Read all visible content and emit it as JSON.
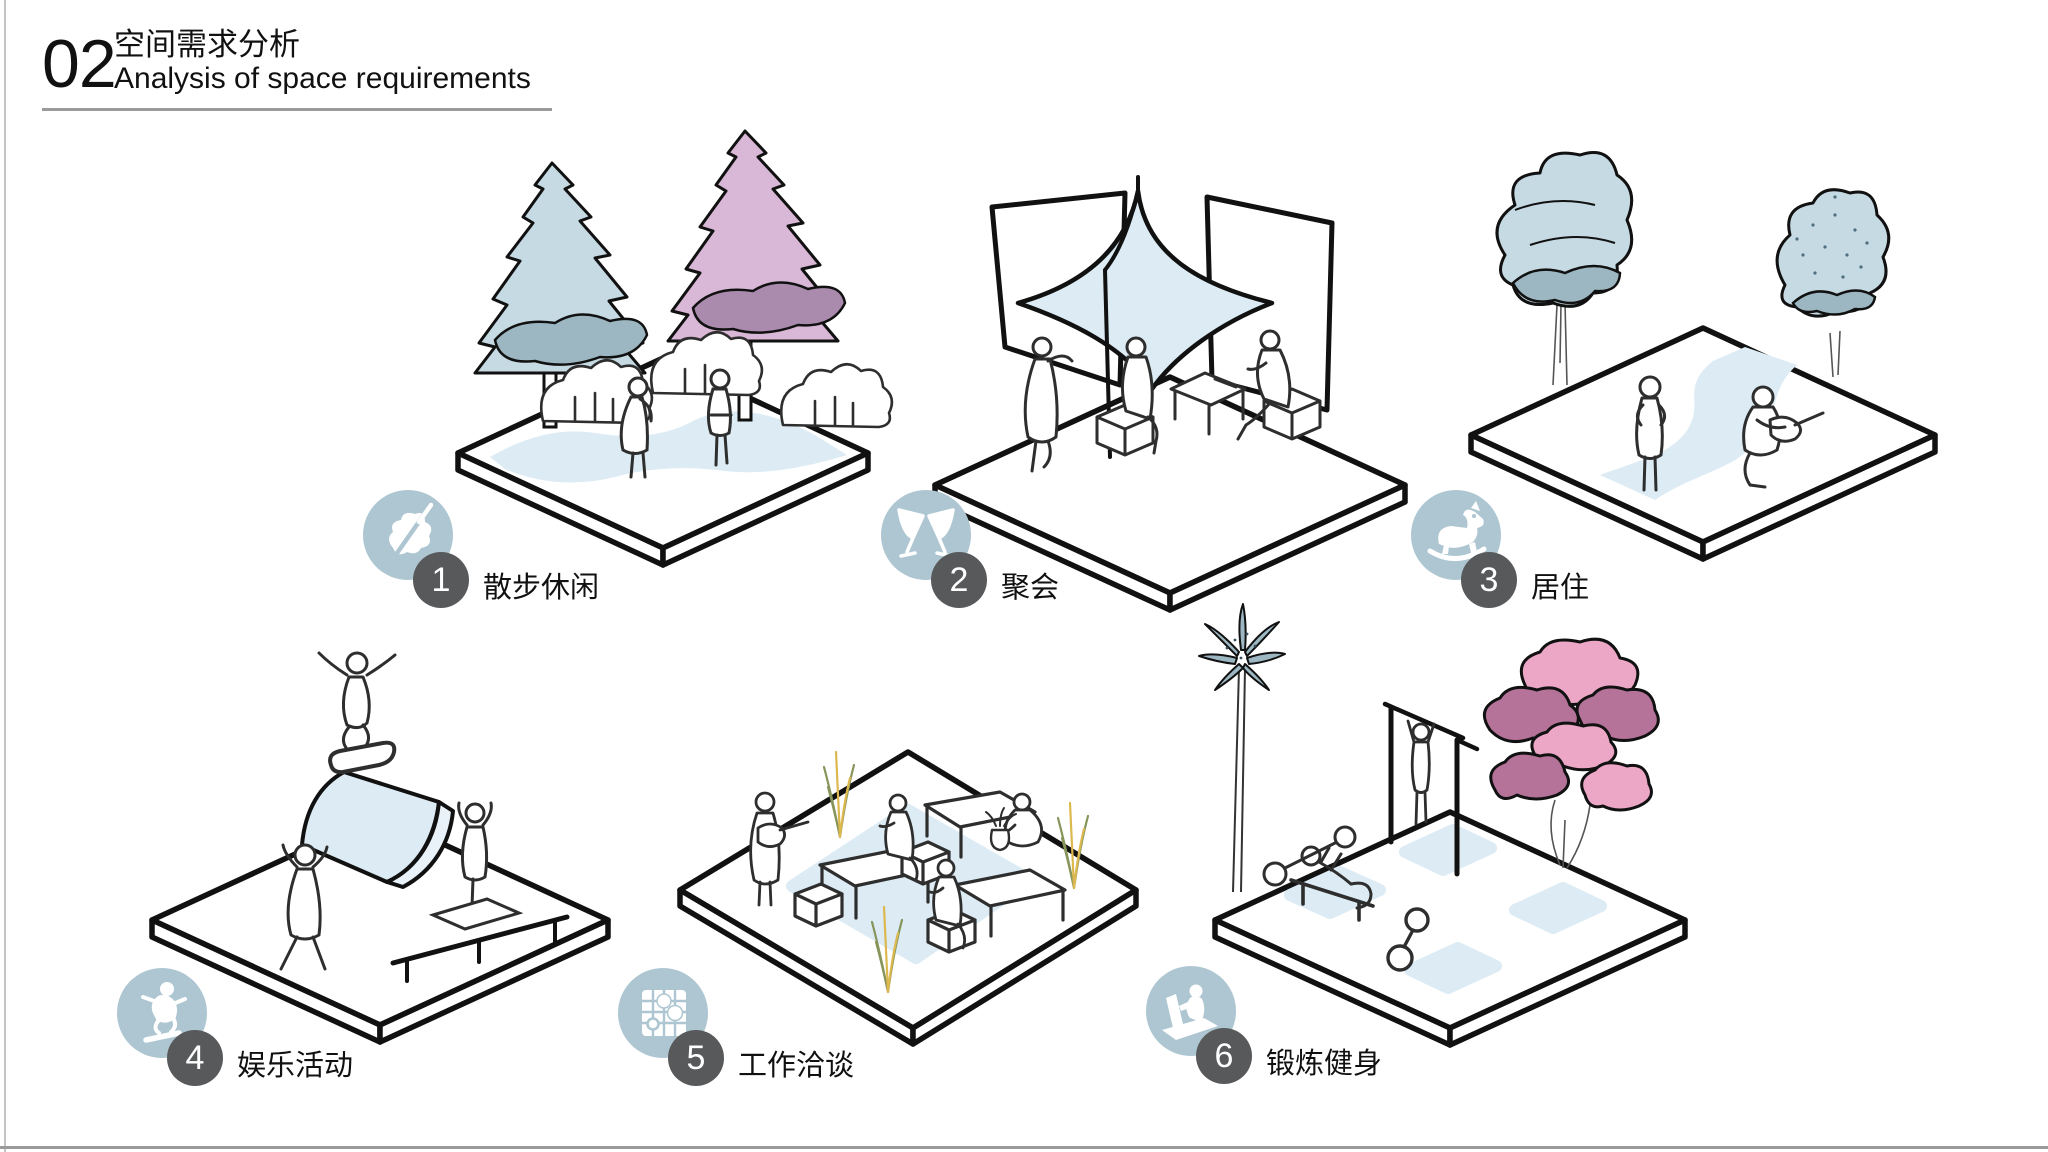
{
  "header": {
    "number": "02",
    "title_zh": "空间需求分析",
    "title_en": "Analysis of space requirements"
  },
  "scenes": [
    {
      "num": "1",
      "label": "散步休闲",
      "icon": "leaf-icon"
    },
    {
      "num": "2",
      "label": "聚会",
      "icon": "toasting-glasses-icon"
    },
    {
      "num": "3",
      "label": "居住",
      "icon": "rocking-horse-icon"
    },
    {
      "num": "4",
      "label": "娱乐活动",
      "icon": "skateboarder-icon"
    },
    {
      "num": "5",
      "label": "工作洽谈",
      "icon": "game-board-icon"
    },
    {
      "num": "6",
      "label": "锻炼健身",
      "icon": "exercise-machine-icon"
    }
  ],
  "colors": {
    "icon_circle": "#adc6d1",
    "number_circle": "#58595b",
    "line_dark": "#111111",
    "figure_line": "#2e2e2e",
    "surface_blue": "#dcebf4",
    "surface_blue_side": "#e9f2f9",
    "tree_blue_light": "#c6dae3",
    "tree_blue_dark": "#9cb7c1",
    "tree_pink_light": "#d9b7d6",
    "tree_pink_dark": "#aa8bae",
    "tree_pink2_light": "#eca7c7",
    "tree_pink2_dark": "#b5739a",
    "grass_yellow": "#ddb84f",
    "grass_green": "#87955a",
    "rule_gray": "#9a9a9a",
    "edge_gray": "#c4c4c4"
  }
}
